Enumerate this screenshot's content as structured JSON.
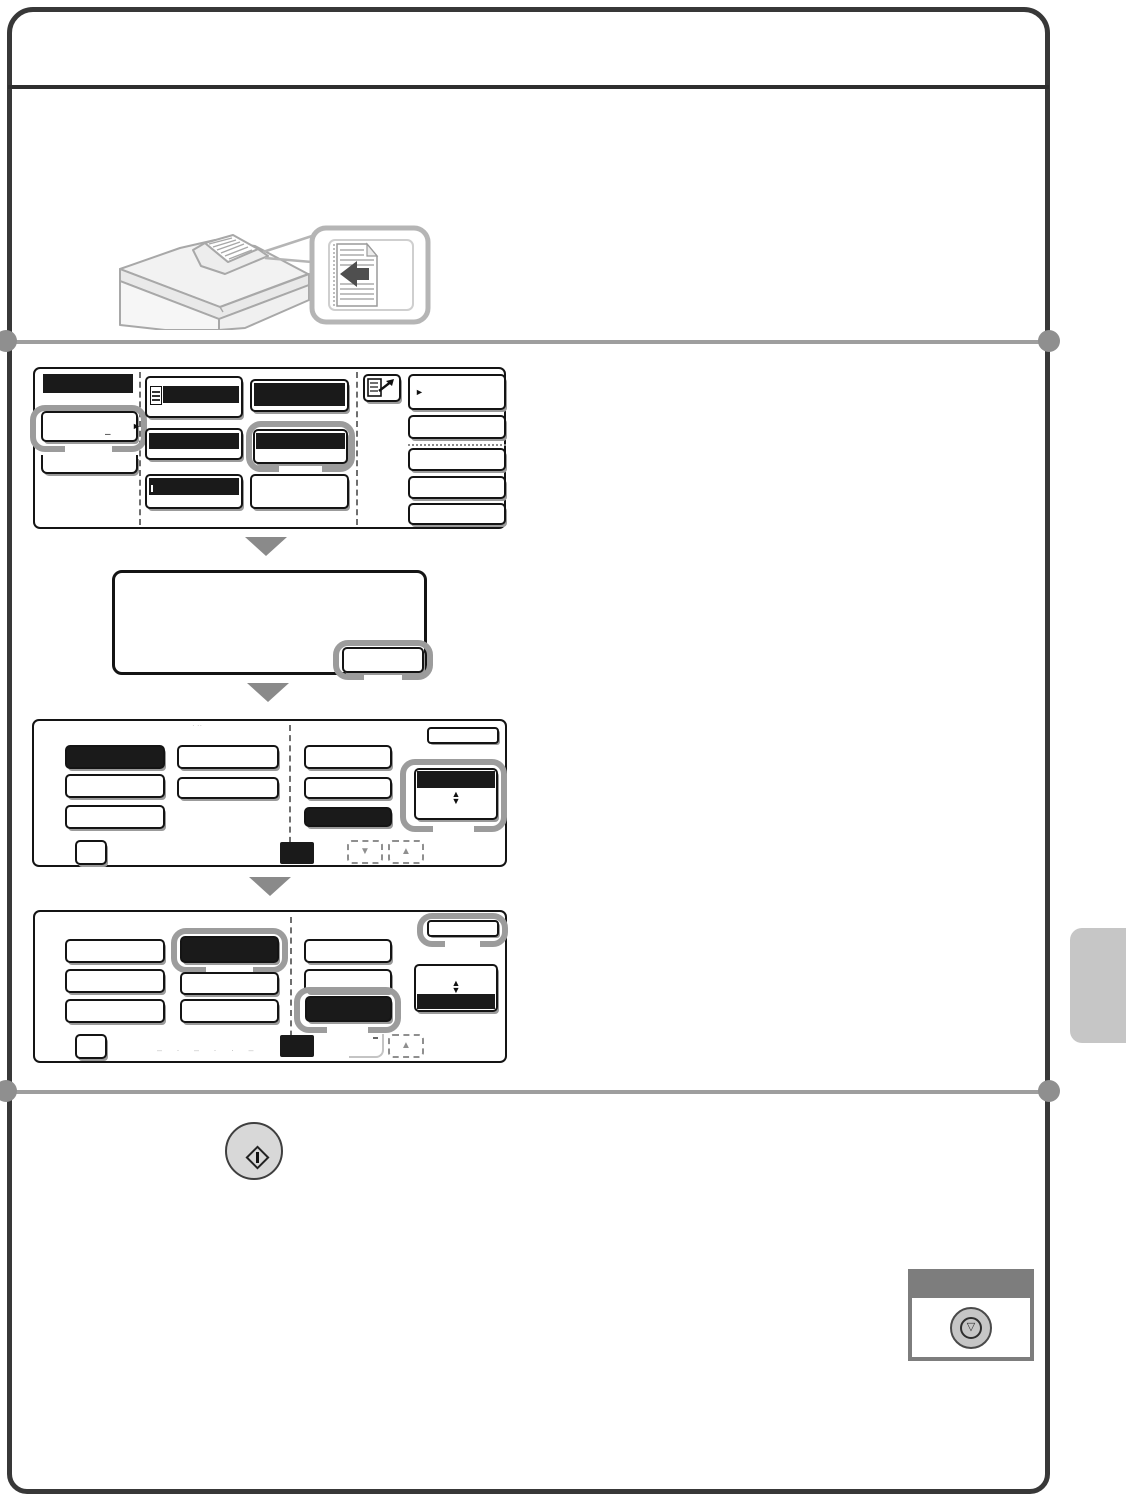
{
  "page": {
    "kind": "copier-operation-manual-page",
    "header_text": "",
    "colors": {
      "page_border": "#383838",
      "key_black": "#1a1a1a",
      "highlight_ring": "#9c9c9c",
      "divider": "#9e9e9e",
      "flow_arrow": "#8a8a8a",
      "illustration_line": "#a8a8a8",
      "callout_border": "#b5b5b5",
      "start_key_fill": "#d8d8d8",
      "stop_header": "#7d7d7d",
      "stop_key_fill": "#c6c6c6",
      "side_tab": "#c6c6c6"
    }
  },
  "glyphs": {
    "right_triangle": "►",
    "up_triangle": "▲",
    "down_triangle": "▼",
    "small_dash": "–",
    "stop_triangle": "▽",
    "screen3_dots": "· ··",
    "screen4_marks": "– · – · · –"
  },
  "illustration": {
    "subject": "copier-with-document-feeder",
    "callout": "original-face-up-feed-arrow"
  },
  "screens": {
    "screen1": {
      "left_panel": [
        "black-title-bar",
        "ring-highlight-key",
        "partial-key"
      ],
      "grid_keys": [
        "icon-plus-black-bar",
        "black-bar",
        "black-bar",
        "black-bar-ring-highlight",
        "black-bar",
        "plain"
      ],
      "corner_icon": "special-modes",
      "right_column": [
        "arrow-key",
        "plain",
        "plain",
        "plain",
        "plain"
      ]
    },
    "screen2": {
      "dialog": "empty-message-box",
      "keys": [
        "ring-highlight-key"
      ]
    },
    "screen3": {
      "left_keys": [
        "black",
        "plain",
        "plain",
        "plain",
        "plain"
      ],
      "right_keys": [
        "plain",
        "plain",
        "black"
      ],
      "spinner": "ring-highlight-black-top",
      "footer": [
        "small-key",
        "black-chip",
        "scroll-down",
        "scroll-up"
      ],
      "corner_key": "plain"
    },
    "screen4": {
      "left_keys": [
        "plain",
        "black-ring-highlight",
        "plain",
        "plain",
        "plain",
        "plain"
      ],
      "right_keys": [
        "plain",
        "plain",
        "black-ring-highlight"
      ],
      "spinner": "black-bottom",
      "footer": [
        "small-key",
        "faint-marks",
        "black-chip",
        "faded-scroll-down",
        "scroll-up"
      ],
      "corner_key": "ring-highlight"
    }
  },
  "hardware_keys": {
    "start": "start-key-circle",
    "stop": "stop-key-in-panel"
  }
}
